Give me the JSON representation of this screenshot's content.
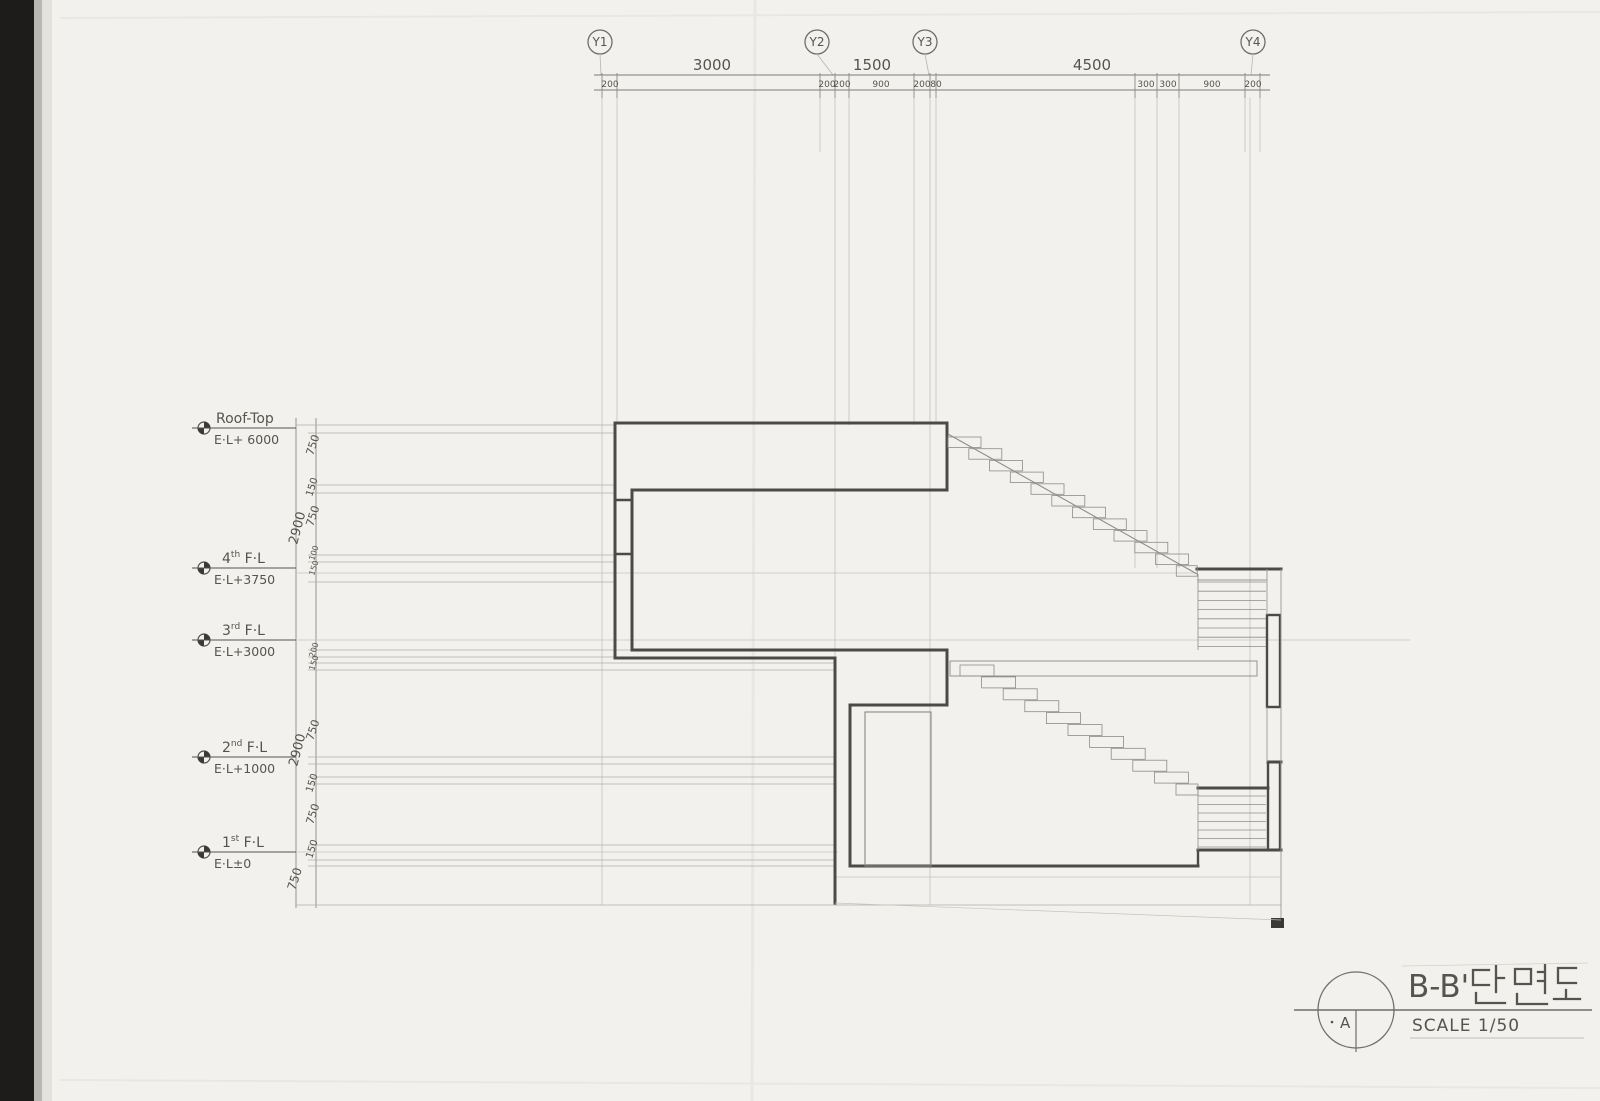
{
  "grid": {
    "bubbles": [
      "Y1",
      "Y2",
      "Y3",
      "Y4"
    ],
    "spans": [
      "3000",
      "1500",
      "4500"
    ],
    "subs": [
      "200",
      "200",
      "200",
      "900",
      "200",
      "80",
      "300",
      "300",
      "900",
      "200"
    ]
  },
  "levels": [
    {
      "pre": "Roof-Top",
      "sup": "",
      "post": "",
      "elev": "E·L+ 6000"
    },
    {
      "pre": "4",
      "sup": "th",
      "post": " F·L",
      "elev": "E·L+3750"
    },
    {
      "pre": "3",
      "sup": "rd",
      "post": " F·L",
      "elev": "E·L+3000"
    },
    {
      "pre": "2",
      "sup": "nd",
      "post": " F·L",
      "elev": "E·L+1000"
    },
    {
      "pre": "1",
      "sup": "st",
      "post": " F·L",
      "elev": "E·L±0"
    }
  ],
  "vdims": [
    "750",
    "150",
    "750",
    "2900",
    "100",
    "150",
    "200",
    "150",
    "750",
    "2900",
    "150",
    "750",
    "150",
    "750"
  ],
  "titleblock": {
    "ref": "A",
    "title_latin": "B-B'",
    "title_hangul": "단면도",
    "title_full": "B-B' 단면도",
    "scale": "SCALE 1/50"
  }
}
